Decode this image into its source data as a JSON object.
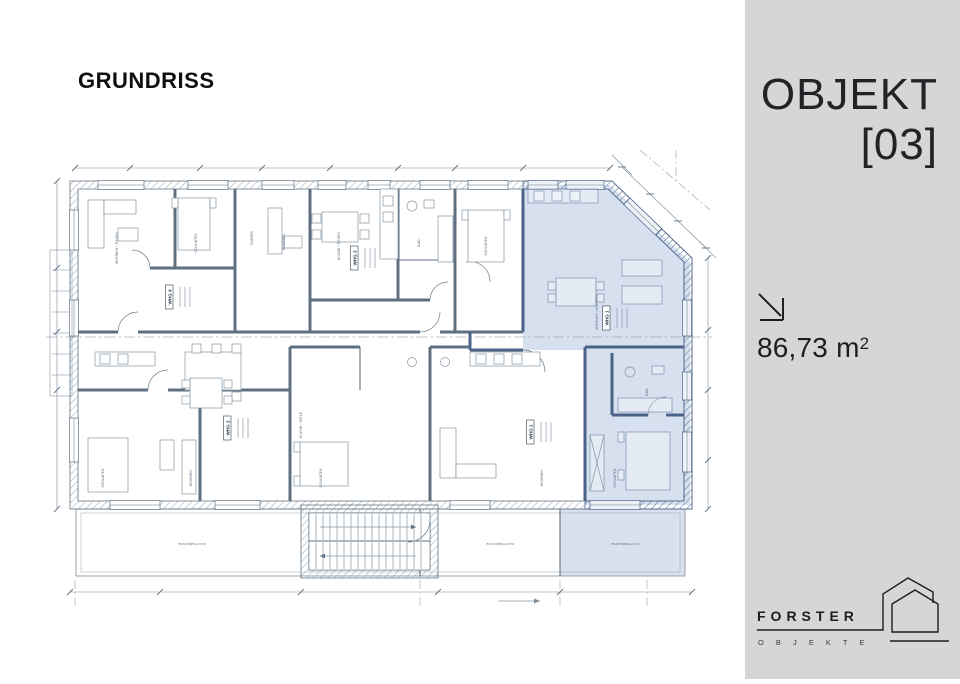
{
  "page": {
    "title": "GRUNDRISS",
    "background": "#ffffff"
  },
  "sidebar": {
    "background": "#d6d6d6",
    "object_line1": "OBJEKT",
    "object_line2": "[03]",
    "area_value": "86,73",
    "area_unit": "m",
    "area_unit_sup": "2",
    "area_icon": "arrow-down-right-icon",
    "brand_name": "FORSTER",
    "brand_sub": "O B J E K T E",
    "brand_icon": "double-house-outline-icon"
  },
  "floorplan": {
    "highlight_color": "#cfdaec",
    "line_color": "#5f7181",
    "highlight_wall_color": "#4a6389",
    "unit_labels": [
      {
        "text": "WHG 4",
        "x": 171,
        "y": 297
      },
      {
        "text": "WHG 3",
        "x": 356,
        "y": 258
      },
      {
        "text": "WHG 2",
        "x": 229,
        "y": 428
      },
      {
        "text": "WHG 1",
        "x": 532,
        "y": 432
      },
      {
        "text": "WHG 1",
        "x": 608,
        "y": 318
      }
    ],
    "room_labels": [
      {
        "text": "WOHNEN / ESSEN",
        "x": 118,
        "y": 248,
        "rot": -90
      },
      {
        "text": "SCHLAFEN",
        "x": 197,
        "y": 243,
        "rot": -90
      },
      {
        "text": "ZIMMER",
        "x": 253,
        "y": 238,
        "rot": -90
      },
      {
        "text": "WOHNEN",
        "x": 285,
        "y": 242,
        "rot": -90
      },
      {
        "text": "KÜCHE / ESSEN",
        "x": 340,
        "y": 246,
        "rot": -90
      },
      {
        "text": "BAD",
        "x": 420,
        "y": 243,
        "rot": -90
      },
      {
        "text": "SCHLAFEN",
        "x": 487,
        "y": 246,
        "rot": -90
      },
      {
        "text": "WOHNEN / KOCHEN",
        "x": 598,
        "y": 312,
        "rot": -90
      },
      {
        "text": "BAD",
        "x": 648,
        "y": 392,
        "rot": -90
      },
      {
        "text": "SCHLAFEN",
        "x": 616,
        "y": 478,
        "rot": -90
      },
      {
        "text": "SCHLAFEN",
        "x": 104,
        "y": 478,
        "rot": -90
      },
      {
        "text": "WOHNEN",
        "x": 192,
        "y": 478,
        "rot": -90
      },
      {
        "text": "KÜCHE / DIELE",
        "x": 302,
        "y": 425,
        "rot": -90
      },
      {
        "text": "SCHLAFEN",
        "x": 322,
        "y": 478,
        "rot": -90
      },
      {
        "text": "WOHNEN",
        "x": 543,
        "y": 478,
        "rot": -90
      }
    ],
    "terrace_labels": [
      {
        "text": "DACHTERRASSE",
        "x": 192,
        "y": 543,
        "rot": 180
      },
      {
        "text": "DACHTERRASSE",
        "x": 500,
        "y": 543,
        "rot": 180
      },
      {
        "text": "DACHTERRASSE",
        "x": 625,
        "y": 543,
        "rot": 180
      }
    ]
  }
}
